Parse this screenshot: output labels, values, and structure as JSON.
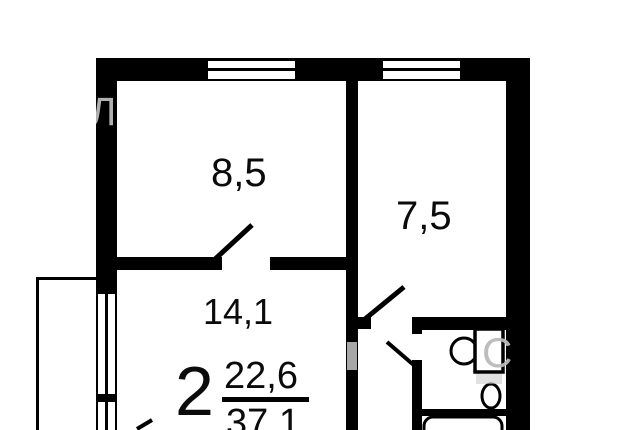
{
  "plan": {
    "kind": "apartment-floor-plan",
    "rooms_count_label": "2",
    "living_area": "22,6",
    "total_area": "37,1",
    "rooms": [
      {
        "id": "room-top-left",
        "area": "8,5"
      },
      {
        "id": "room-top-right",
        "area": "7,5"
      },
      {
        "id": "room-middle",
        "area": "14,1"
      }
    ],
    "fixtures": [
      "toilet",
      "sink",
      "bathtub",
      "balcony"
    ],
    "colors": {
      "wall": "#000000",
      "background": "#ffffff",
      "watermark": "#b9b9b9"
    },
    "watermark_fragments": {
      "left_wall": "Л",
      "corridor_wall": "І",
      "right_wall": "С"
    }
  }
}
